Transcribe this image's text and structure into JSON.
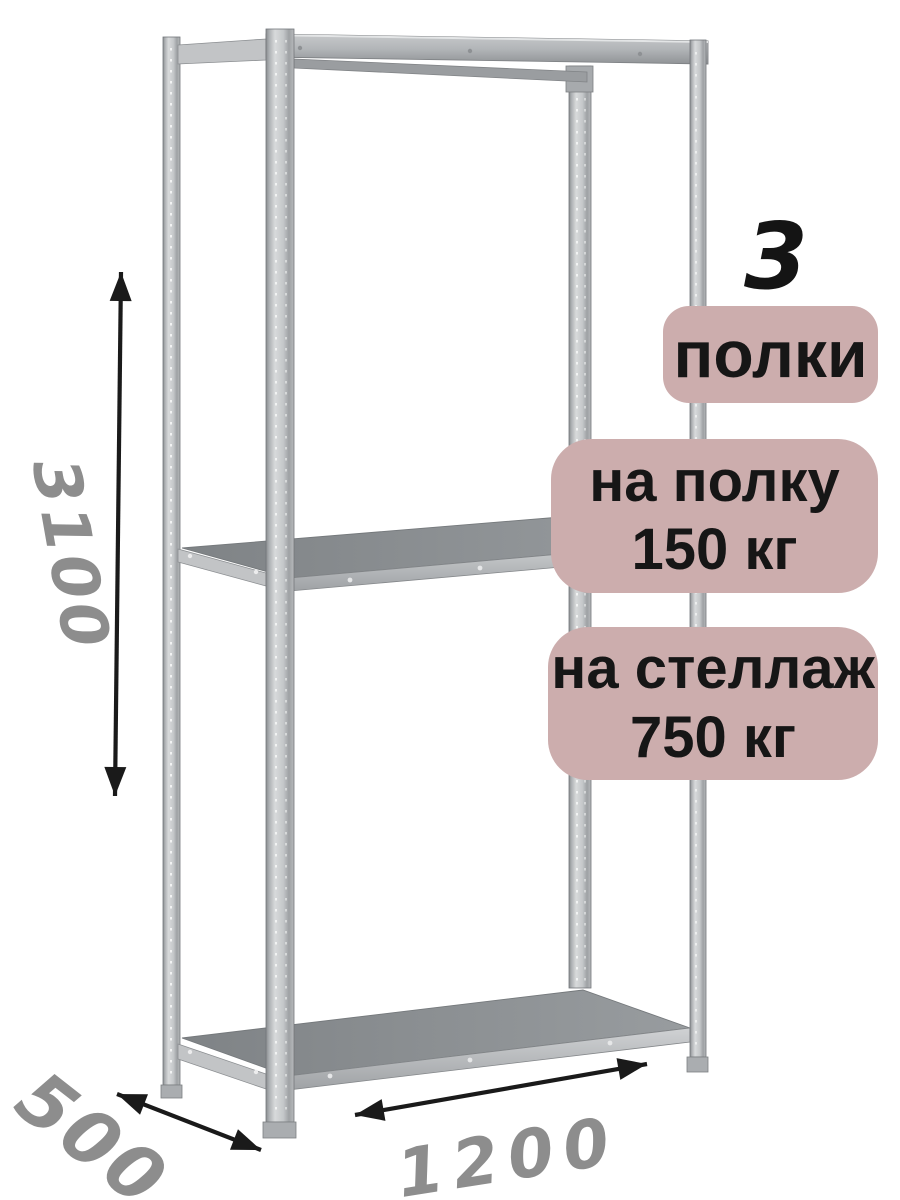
{
  "rack": {
    "shelf_count": "3",
    "shelf_count_unit": "полки",
    "shelf_load": {
      "line1": "на полку",
      "line2": "150 кг"
    },
    "rack_load": {
      "line1": "на стеллаж",
      "line2": "750 кг"
    },
    "dimensions": {
      "height": "3100",
      "depth": "500",
      "width": "1200"
    }
  },
  "colors": {
    "background": "#ffffff",
    "badge_background": "#ccadad",
    "badge_text": "#161616",
    "count_text": "#141414",
    "dimension_label": "#8d8d8d",
    "arrow": "#1a1a1a",
    "metal_light": "#d8dadb",
    "metal_mid": "#b0b3b6",
    "metal_dark": "#8a8d90",
    "shelf_surface": "#8a8e91"
  }
}
